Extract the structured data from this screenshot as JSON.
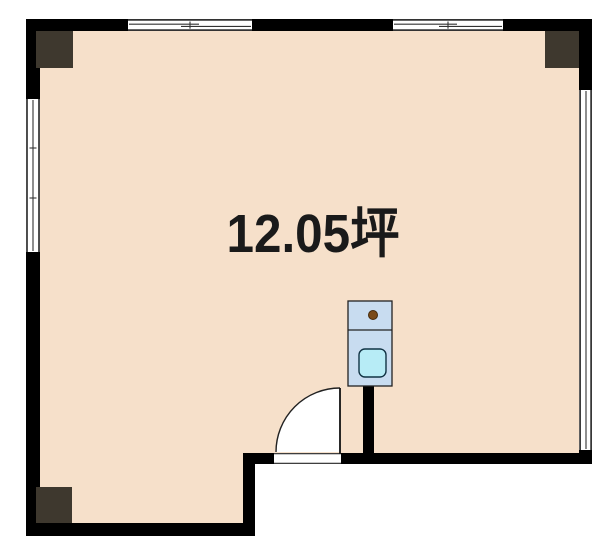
{
  "plan": {
    "title": "room-floor-plan",
    "area_label": "12.05坪",
    "colors": {
      "background": "#ffffff",
      "wall": "#000000",
      "floor": "#f6e0ca",
      "pillar": "#3e382e",
      "text": "#1a1a1a",
      "opening": "#ffffff",
      "fixture_body": "#c8dcf0",
      "fixture_basin": "#b7ecf6",
      "fixture_knob": "#7a4a18"
    },
    "symbols": {
      "door": "hinged-door-quarter-arc",
      "fixture": "sink-unit",
      "windows": [
        "top-left-sliding-window",
        "top-right-sliding-window",
        "left-sliding-window",
        "right-sliding-window"
      ],
      "pillars": [
        "top-left-pillar",
        "top-right-pillar",
        "bottom-left-pillar"
      ]
    }
  }
}
